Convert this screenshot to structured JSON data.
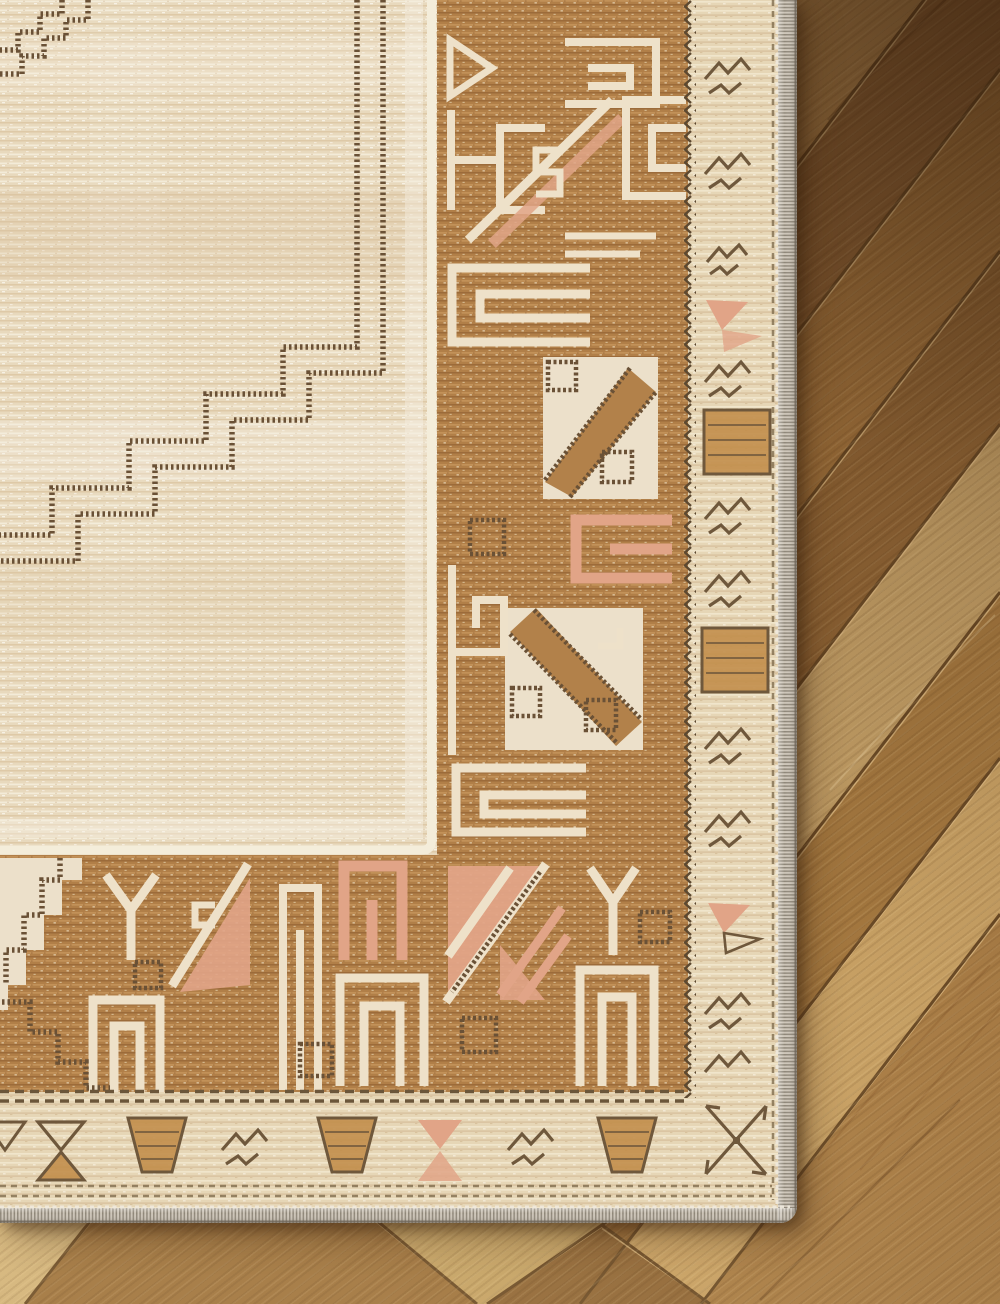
{
  "scene": {
    "description": "Close-up photograph of the corner of a cream and caramel Turkish-style area rug lying on diagonal herringbone oak hardwood flooring",
    "view": "top-down detail shot",
    "regions": {
      "rug": "fills upper-left, right edge of rug at ~80% width, bottom edge near bottom of frame",
      "floor": "vertical strip along right side and thin strip across the bottom"
    }
  },
  "rug": {
    "field": "cream field with fine horizontal weave striations",
    "medallion_line": "double stepped dotted dark-brown line descending from top edge toward lower left",
    "corner_stub": "small stepped double line fragment in extreme top-left corner",
    "inner_guard_line": "thin white guard line between field and main border",
    "main_border": "caramel tan border with cream geometric fret, key, gate and diagonal motifs plus salmon accents",
    "zigzag_separator": "dark zigzag line between main border and outer guard band",
    "outer_guard": "cream guard band with small brown tribal motifs, gold baskets, bowties and salmon triangles",
    "binding": "grey serged whipstitch edge binding with rounded outer corner"
  },
  "floor": {
    "material": "oak hardwood planks",
    "layout": "planks run diagonally rising to the right (~52 deg); herringbone V-junctions visible in strip below the rug",
    "right_column_seam_ys_at_rug_edge": [
      165,
      333,
      515,
      688,
      856,
      1022,
      1178
    ],
    "lighting": "darker toward upper right, pale golden toward lower right"
  },
  "palette": {
    "field_cream": "#e8d9bd",
    "field_stripe_light": "#f3ebd8",
    "field_stripe_dark": "#dcc7a4",
    "border_tan": "#b2814a",
    "motif_cream": "#eee1c9",
    "salmon": "#e1a487",
    "gold": "#c28e4b",
    "dark_brown": "#6a5136",
    "guard_cream": "#e6d6b6",
    "guard_motif_brown": "#6f583c",
    "serge_light": "#cdc5b8",
    "serge_dark": "#8e8678",
    "wood_dark": "#8c6136",
    "wood_medium": "#a3773f",
    "wood_light": "#c69f63",
    "wood_pale": "#d2b37b",
    "seam_dark": "#6a4a26",
    "seam_highlight": "#dfbc85"
  }
}
